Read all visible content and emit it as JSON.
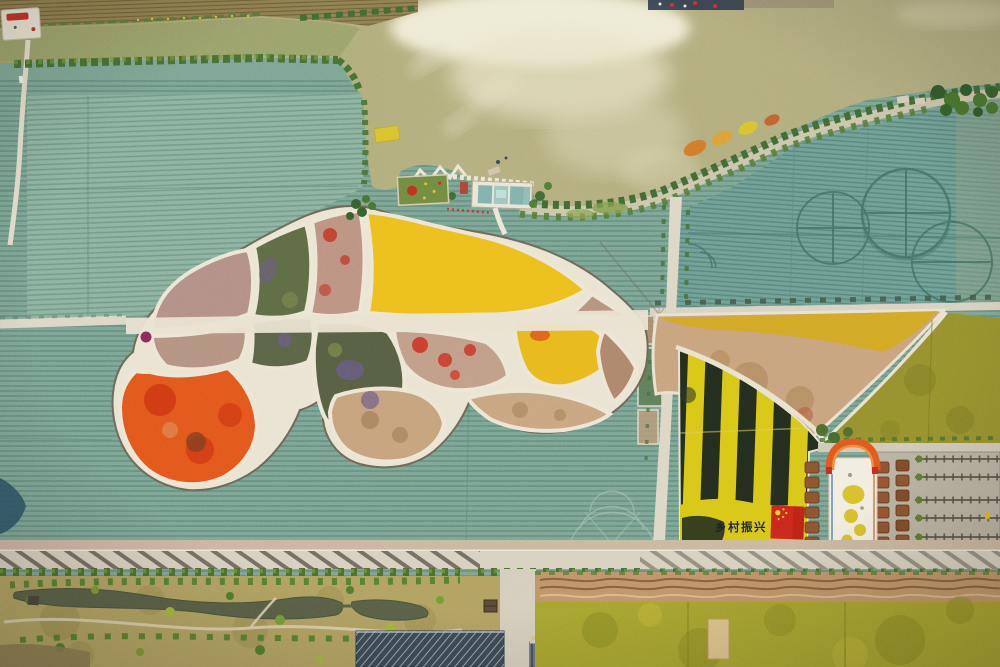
{
  "scene": {
    "title": "Aerial view of a fish-shaped flower field park beside a lake",
    "banner": {
      "text": "乡村振兴"
    },
    "palette": {
      "field_teal": "#7BA495",
      "field_teal_light": "#8CB2A0",
      "field_teal_dark": "#6F9E95",
      "lake_water": "#AFAA7C",
      "sun_glint": "#F2EEDA",
      "park_path": "#ECE5D4",
      "flower_yellow": "#ECBE1D",
      "flower_orange": "#E2561C",
      "flower_red": "#C62F1E",
      "flower_purple": "#6B5A8C",
      "flower_mauve": "#B18E86",
      "stripe_yellow": "#D8C617",
      "stripe_dark": "#232D1F",
      "flag_red": "#C8271A",
      "arch_orange": "#E2561C",
      "road": "#D7D0C0",
      "tree_green": "#456F33",
      "tail_tan": "#C7A27D",
      "olive_field": "#958F2E",
      "greenhouse_blue": "#3C4855",
      "pond_dark": "#575F47"
    }
  }
}
